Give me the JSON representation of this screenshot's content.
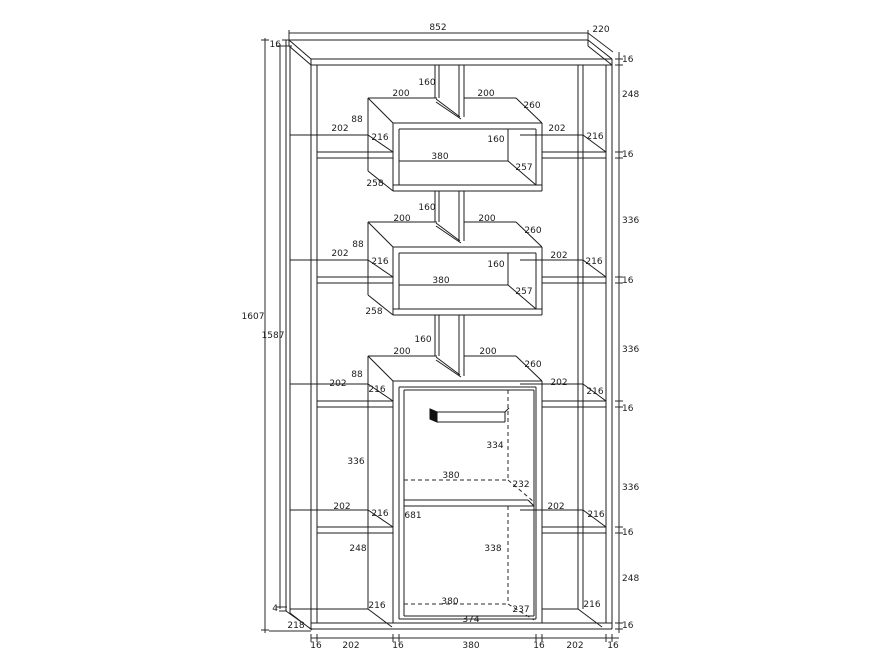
{
  "style": {
    "background": "#ffffff",
    "line_color": "#1c1c1c",
    "text_color": "#1b1b1b"
  },
  "dims": {
    "top": {
      "width": "852",
      "depth": "220",
      "thickness_left": "16"
    },
    "left": {
      "total_height": "1607",
      "inner_height": "1587",
      "base": "4",
      "bottom_depth": "218"
    },
    "right_chain": [
      "16",
      "248",
      "16",
      "336",
      "16",
      "336",
      "16",
      "336",
      "16",
      "248",
      "16"
    ],
    "bottom_chain": [
      "16",
      "202",
      "16",
      "380",
      "16",
      "202",
      "16"
    ],
    "box1": {
      "divider": "160",
      "span_left": "200",
      "span_right": "200",
      "depth": "260",
      "side": "88",
      "shelf_left": {
        "w": "202",
        "d": "216"
      },
      "shelf_right": {
        "w": "202",
        "d": "216"
      },
      "inner_h": "160",
      "inner_w": "380",
      "inner_d": "257",
      "bottom_d": "258"
    },
    "box2": {
      "divider": "160",
      "span_left": "200",
      "span_right": "200",
      "depth": "260",
      "side": "88",
      "shelf_left": {
        "w": "202",
        "d": "216"
      },
      "shelf_right": {
        "w": "202",
        "d": "216"
      },
      "inner_h": "160",
      "inner_w": "380",
      "inner_d": "257",
      "bottom_d": "258"
    },
    "box3": {
      "divider": "160",
      "span_left": "200",
      "span_right": "200",
      "depth": "260",
      "side": "88",
      "shelf_left": {
        "w": "202",
        "d": "216"
      },
      "shelf_right": {
        "w": "202",
        "d": "216"
      },
      "handle_drop": "334",
      "mid_w": "380",
      "mid_d": "232",
      "inner_h": "681",
      "lower_h": "338",
      "lower_w": "380",
      "lower_d": "237",
      "door_w": "374"
    },
    "left_col": {
      "gap_mid": "336",
      "shelf": {
        "w": "202",
        "d": "216"
      },
      "gap_low": "248",
      "bottom_d": "216"
    },
    "right_col": {
      "shelf": {
        "w": "202",
        "d": "216"
      },
      "bottom_d": "216"
    }
  }
}
